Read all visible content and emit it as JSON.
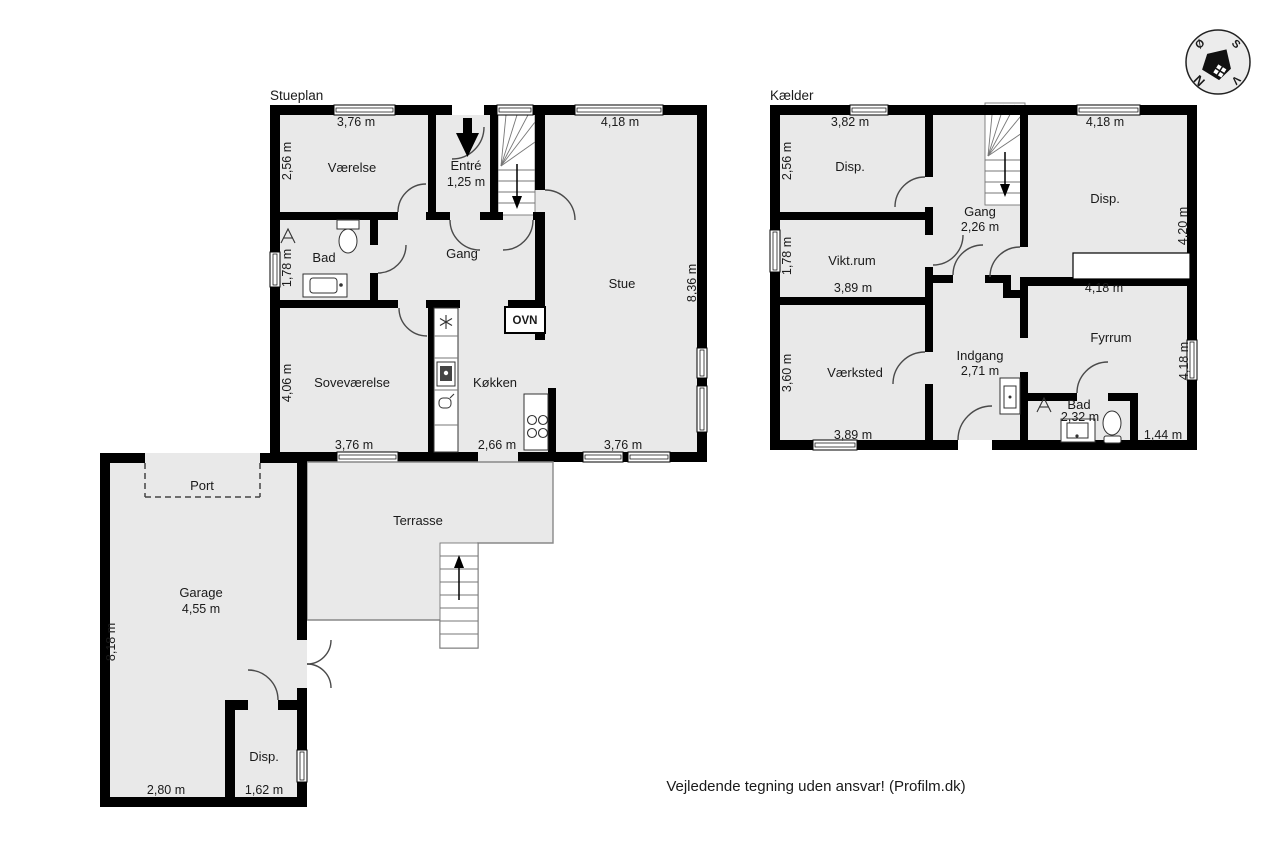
{
  "stueplan": {
    "title": "Stueplan",
    "vaerelse": "Værelse",
    "entre_name": "Entré",
    "entre_size": "1,25 m",
    "bad": "Bad",
    "gang": "Gang",
    "stue": "Stue",
    "sovevaerelse": "Soveværelse",
    "koekken": "Køkken",
    "ovn": "OVN",
    "m_top_left": "3,76 m",
    "m_top_right": "4,18 m",
    "m_left_1": "2,56 m",
    "m_left_2": "1,78 m",
    "m_left_3": "4,06 m",
    "m_right": "8,36 m",
    "m_bottom_1": "3,76 m",
    "m_bottom_2": "2,66 m",
    "m_bottom_3": "3,76 m"
  },
  "kaelder": {
    "title": "Kælder",
    "disp_left": "Disp.",
    "disp_right": "Disp.",
    "gang_name": "Gang",
    "gang_size": "2,26 m",
    "vikt": "Vikt.rum",
    "vaerksted": "Værksted",
    "indgang_name": "Indgang",
    "indgang_size": "2,71 m",
    "fyrrum": "Fyrrum",
    "bad_name": "Bad",
    "bad_size": "2,32 m",
    "m_top_left": "3,82 m",
    "m_top_right": "4,18 m",
    "m_left_1": "2,56 m",
    "m_left_2": "1,78 m",
    "m_left_3": "3,60 m",
    "m_vikt_bottom": "3,89 m",
    "m_vaerksted_bottom": "3,89 m",
    "m_fyrrum_top": "4,18 m",
    "m_fyrrum_right": "4,18 m",
    "m_disp_right": "4,20 m",
    "m_bad_right": "1,44 m"
  },
  "garage": {
    "port": "Port",
    "garage_name": "Garage",
    "garage_size": "4,55 m",
    "disp": "Disp.",
    "terrasse": "Terrasse",
    "m_left": "8,18 m",
    "m_bottom_1": "2,80 m",
    "m_bottom_2": "1,62 m"
  },
  "compass": {
    "north": "N",
    "south": "S",
    "east": "Ø",
    "west": "V"
  },
  "footer": "Vejledende tegning uden ansvar! (Profilm.dk)",
  "colors": {
    "wall": "#000000",
    "room_fill": "#e9e9e9",
    "door_arc": "#4a4a4a"
  }
}
